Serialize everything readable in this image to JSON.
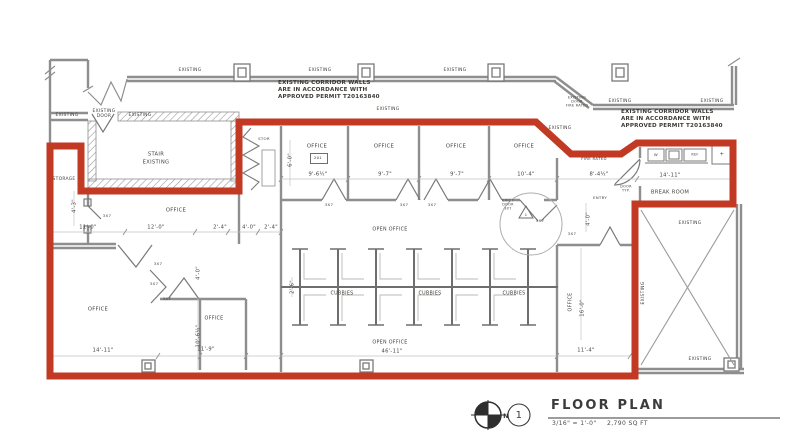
{
  "colors": {
    "boundary_red": "#c23a23",
    "wall_gray": "#8e8e8e",
    "ink": "#45423d"
  },
  "notes": {
    "left": [
      "EXISTING CORRIDOR WALLS",
      "ARE IN ACCORDANCE WITH",
      "APPROVED PERMIT T20163840"
    ],
    "right": [
      "EXISTING CORRIDOR WALLS",
      "ARE IN ACCORDANCE WITH",
      "APPROVED PERMIT T20163840"
    ]
  },
  "rooms": {
    "stair": [
      "STAIR",
      "EXISTING"
    ],
    "storage": "STORAGE",
    "stor": "STOR",
    "office": "OFFICE",
    "office_tag": "201",
    "open_office": "OPEN OFFICE",
    "cubbies": "CUBBIES",
    "break_room": "BREAK ROOM",
    "existing": "EXISTING",
    "existing_door": [
      "EXISTING",
      "DOOR"
    ]
  },
  "annotations": {
    "door_size": "3X7",
    "fire_rated": "FIRE RATED",
    "entry": "ENTRY",
    "door_typ": [
      "DOOR",
      "TYP."
    ],
    "exist_door_note": [
      "EXIST",
      "DOOR",
      "3X7"
    ],
    "exist_fire_note": [
      "EXISTING",
      "DOOR",
      "FIRE RATED"
    ],
    "revision": "1",
    "counter": {
      "w": "W",
      "ref": "REF",
      "plus": "+"
    }
  },
  "dimensions": {
    "d11_0": "11'-0\"",
    "d12_0": "12'-0\"",
    "d2_4": "2'-4\"",
    "d4_0": "4'-0\"",
    "d4_3": "4'-3\"",
    "d9_6h": "9'-6½\"",
    "d9_7": "9'-7\"",
    "d10_4": "10'-4\"",
    "d8_4h": "8'-4½\"",
    "d14_11": "14'-11\"",
    "d11_9": "11'-9\"",
    "d10_6h": "10'-6½\"",
    "d46_11": "46'-11\"",
    "d16_0": "16'-0\"",
    "d11_4": "11'-4\"",
    "d6_0": "6'-0\"",
    "d2_6": "2'-6\""
  },
  "title_block": {
    "north": "N",
    "detail_number": "1",
    "title": "FLOOR PLAN",
    "scale": "3/16\" = 1'-0\"",
    "area": "2,790 SQ FT"
  }
}
